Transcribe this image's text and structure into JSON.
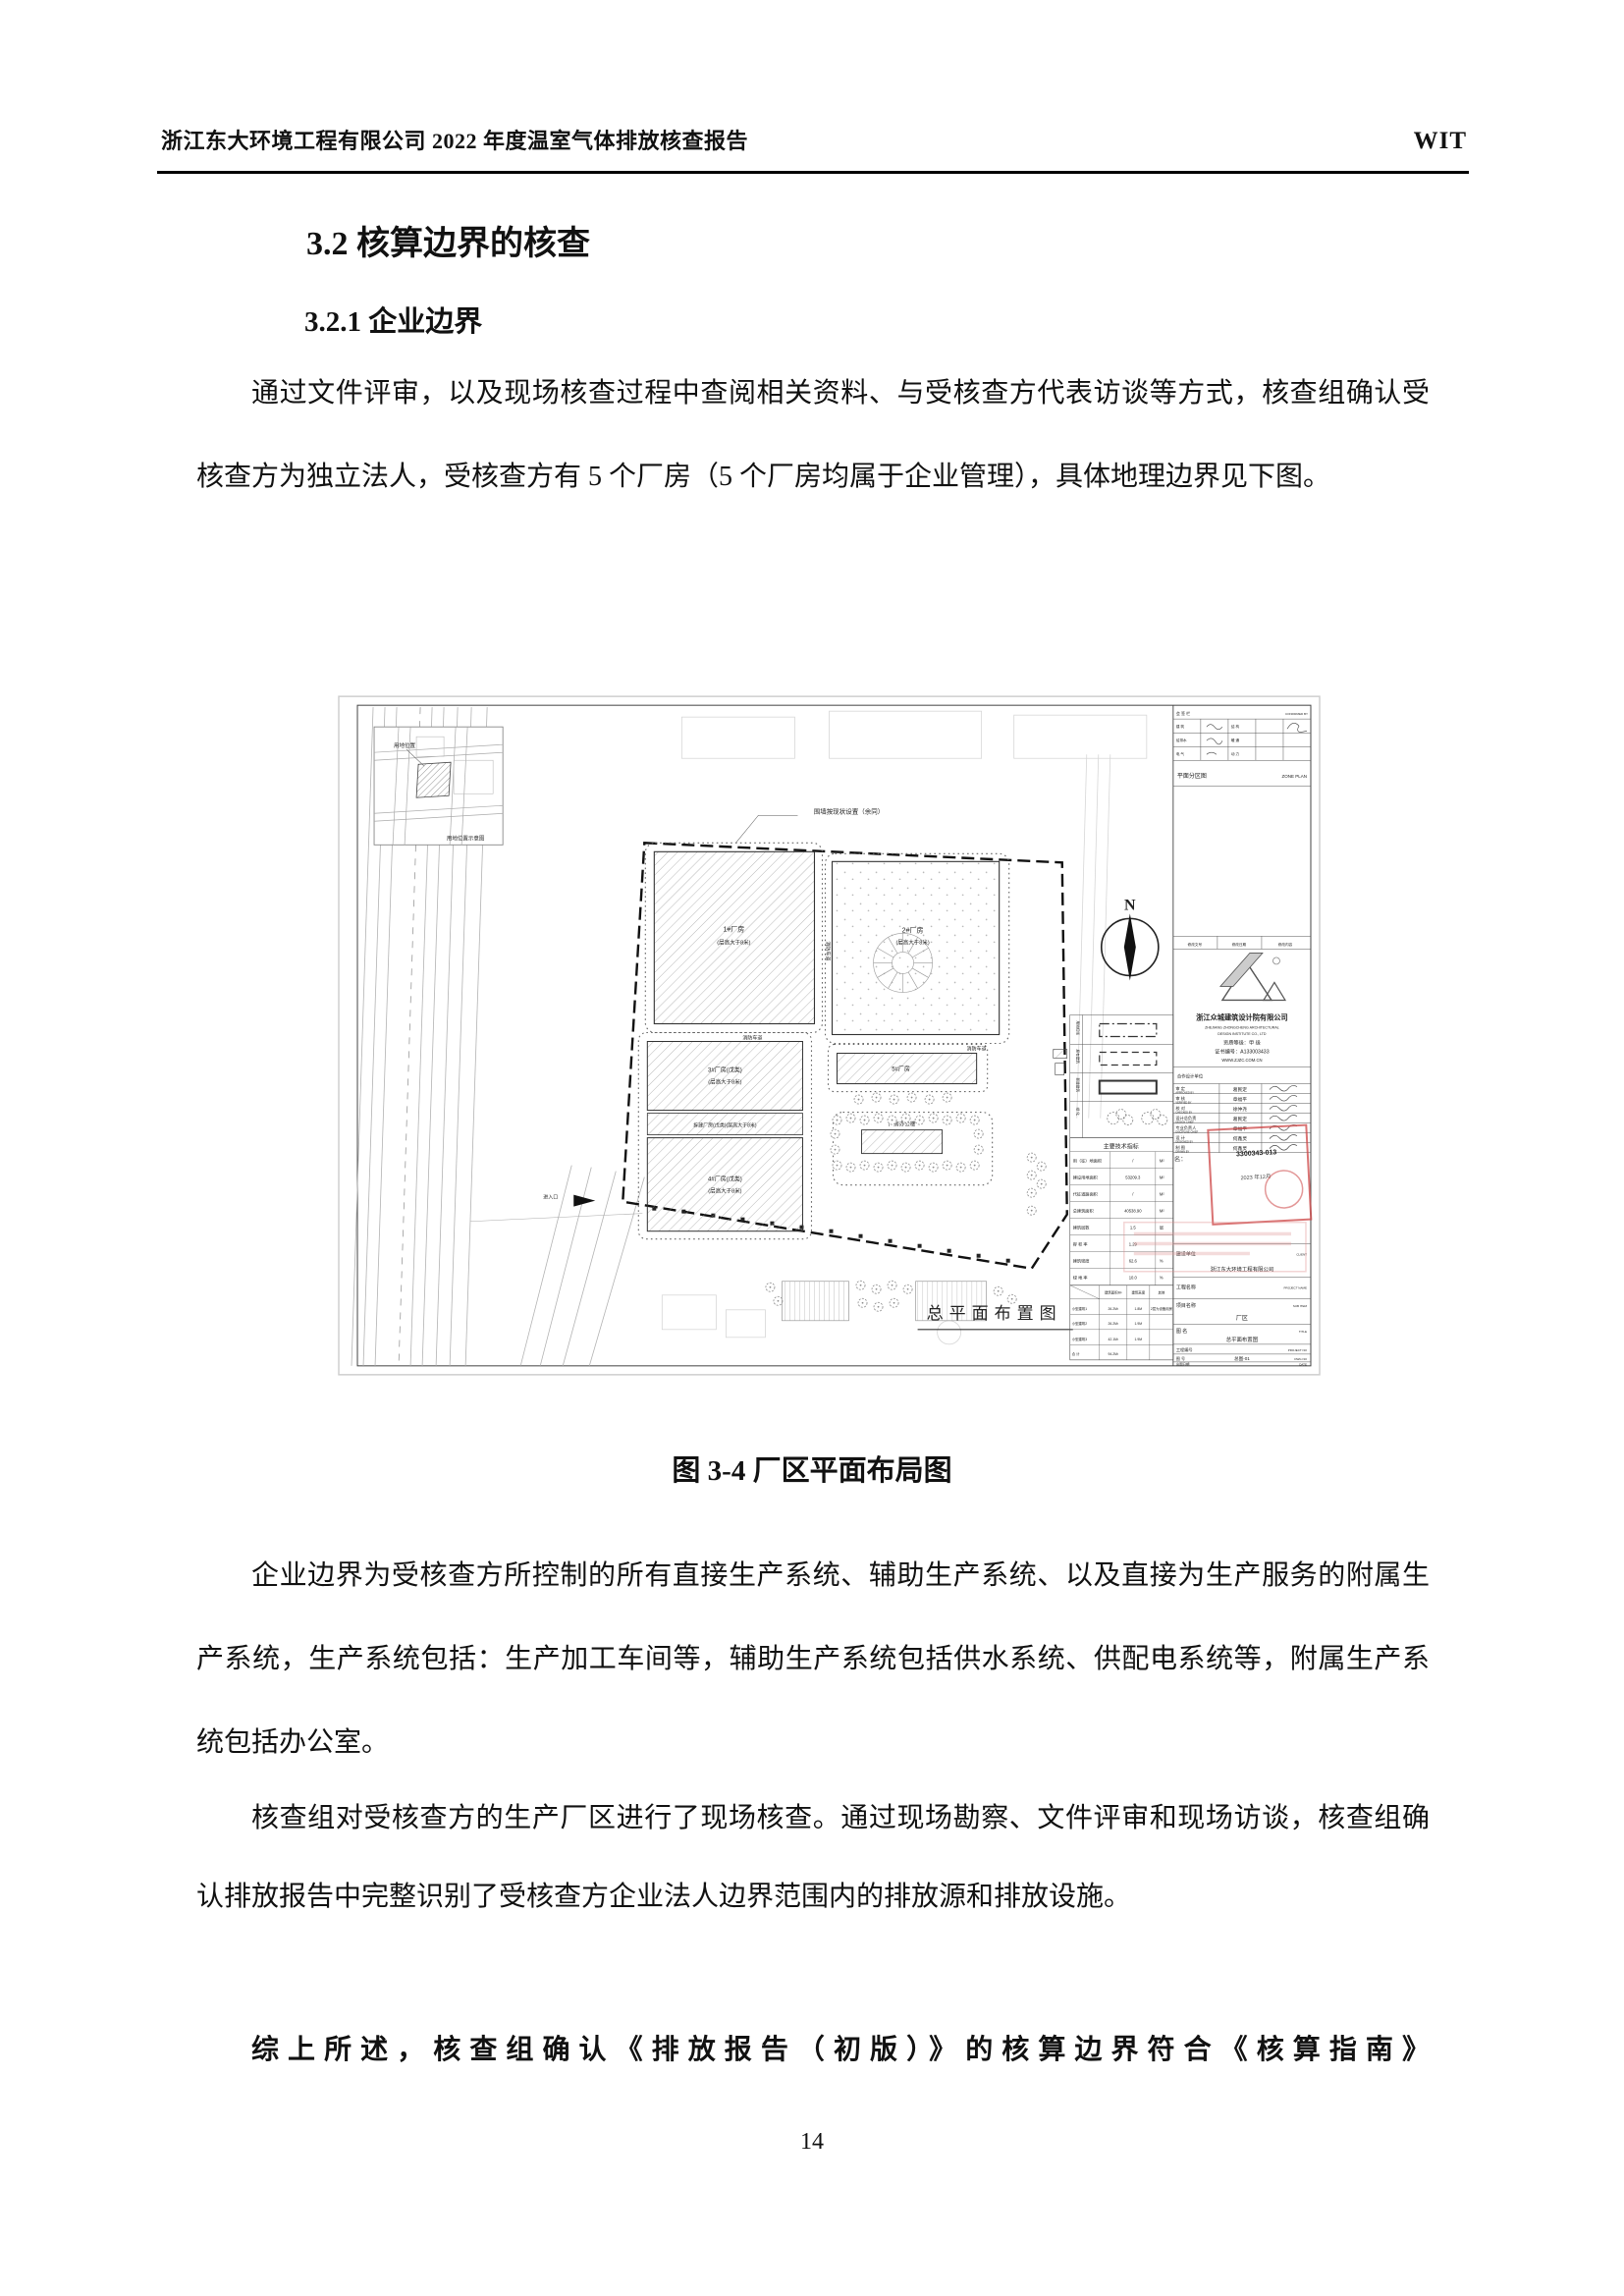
{
  "header": {
    "left": "浙江东大环境工程有限公司 2022 年度温室气体排放核查报告",
    "right": "WIT"
  },
  "headings": {
    "h32": "3.2 核算边界的核查",
    "h321": "3.2.1 企业边界"
  },
  "paragraphs": {
    "p1": "通过文件评审，以及现场核查过程中查阅相关资料、与受核查方代表访谈等方式，核查组确认受核查方为独立法人，受核查方有 5 个厂房（5 个厂房均属于企业管理），具体地理边界见下图。",
    "p2": "企业边界为受核查方所控制的所有直接生产系统、辅助生产系统、以及直接为生产服务的附属生产系统，生产系统包括：生产加工车间等，辅助生产系统包括供水系统、供配电系统等，附属生产系统包括办公室。",
    "p3": "核查组对受核查方的生产厂区进行了现场核查。通过现场勘察、文件评审和现场访谈，核查组确认排放报告中完整识别了受核查方企业法人边界范围内的排放源和排放设施。",
    "p4": "综上所述，核查组确认《排放报告（初版）》的核算边界符合《核算指南》"
  },
  "figure": {
    "caption": "图 3-4  厂区平面布局图"
  },
  "page_number": "14",
  "drawing": {
    "annotation_top": "围墙按现状设置（余同）",
    "north": "N",
    "road_label": "消防车道",
    "entrance_label": "进入口",
    "plan_title": "总平面布置图",
    "inset": {
      "label": "用地位置",
      "caption": "用地位置示意图"
    },
    "buildings": {
      "b1a": "1#厂房",
      "b1b": "(层高大于8米)",
      "b2a": "2#厂房",
      "b2b": "(层高大于8米)",
      "b3a": "3#厂房(戊类)",
      "b3b": "(层高大于8米)",
      "strip": "拆建厂房(戊类)(层高大于8米)",
      "b4a": "4#厂房(戊类)",
      "b4b": "(层高大于8米)",
      "b5": "5#厂房",
      "office": "厂房办公楼"
    },
    "legend_labels": [
      "用地红线",
      "原有建筑",
      "新建建筑",
      "绿  化"
    ],
    "indicators": {
      "title": "主要技术指标",
      "rows": [
        {
          "label": "用（征）地面积",
          "value": "/",
          "unit": "M²"
        },
        {
          "label": "建设用地面积",
          "value": "53209.3",
          "unit": "M²"
        },
        {
          "label": "代征道路面积",
          "value": "/",
          "unit": "M²"
        },
        {
          "label": "总建筑面积",
          "value": "40538.90",
          "unit": "M²"
        },
        {
          "label": "建筑层数",
          "value": "1.5",
          "unit": "层"
        },
        {
          "label": "容 积 率",
          "value": "1.29",
          "unit": ""
        },
        {
          "label": "建筑密度",
          "value": "62.6",
          "unit": "%"
        },
        {
          "label": "绿 地 率",
          "value": "10.0",
          "unit": "%"
        }
      ]
    },
    "smalltable": {
      "h1": "建筑面积M²",
      "h2": "建筑高度",
      "h3": "其他",
      "rows": [
        {
          "label": "小型建筑1",
          "area": "26.2M²",
          "height": "1.8M",
          "other": "2层为设备用房"
        },
        {
          "label": "小型建筑2",
          "area": "26.2M²",
          "height": "1.9M",
          "other": ""
        },
        {
          "label": "小型建筑3",
          "area": "42.1M²",
          "height": "1.9M",
          "other": ""
        },
        {
          "label": "合  计",
          "area": "94.2M²",
          "height": "",
          "other": ""
        }
      ]
    },
    "titleblock": {
      "signoff_cn": "会 签 栏",
      "signoff_en": "CONFIRMED BY",
      "mini_r1a": "建  筑",
      "mini_r1b": "结  构",
      "mini_r2a": "给排水",
      "mini_r2b": "暖  通",
      "mini_r3a": "电  气",
      "mini_r3b": "动  力",
      "zone_cn": "平面分区图",
      "zone_en": "ZONE PLAN",
      "rev1": "修改文号",
      "rev2": "修改日期",
      "rev3": "修改内容",
      "company_cn": "浙江众城建筑设计院有限公司",
      "company_en1": "ZHEJIANG ZHONGCHENG ARCHITECTURAL",
      "company_en2": "DESIGN INSTITUTE CO., LTD",
      "grade": "资质等级：甲  级",
      "cert": "证书编号：A133003433",
      "site": "WWW.ZJZC.COM.CN",
      "coop": "合作设计单位",
      "signs": [
        {
          "cn": "审  定",
          "en": "APPROVED BY",
          "name": "葛民定"
        },
        {
          "cn": "审  核",
          "en": "VERIFIED BY",
          "name": "章福平"
        },
        {
          "cn": "校  对",
          "en": "CHECKED BY",
          "name": "徐仲尧"
        },
        {
          "cn": "设计总负责",
          "en": "DESIGN CHIEF",
          "name": "葛民定"
        },
        {
          "cn": "专业负责人",
          "en": "DISCIPLINE CHIEF",
          "name": "章福平"
        },
        {
          "cn": "设  计",
          "en": "DESIGNED BY",
          "name": "何鑫灵"
        },
        {
          "cn": "制  图",
          "en": "DRAWN BY",
          "name": "何鑫灵"
        }
      ],
      "stamp_name": "名：",
      "stamp_no": "3300343-013",
      "stamp_date": "2023 年12月",
      "client_cn": "建设单位",
      "client_en": "CLIENT",
      "client_name": "浙江东大环境工程有限公司",
      "project_cn": "工程名称",
      "project_en": "PROJECT NAME",
      "subitem_cn": "项目名称",
      "subitem_en": "SUB ITEM",
      "subitem_val": "厂区",
      "title_cn": "图  名",
      "title_en": "TITLE",
      "title_val": "总平面布置图",
      "projno_cn": "工程编号",
      "projno_en": "PROJECT NO",
      "dwgno_cn": "图  号",
      "dwgno_en": "DWG NO",
      "dwgno_val": "总图-01",
      "date_cn": "出图日期",
      "date_en": "DATE"
    }
  }
}
